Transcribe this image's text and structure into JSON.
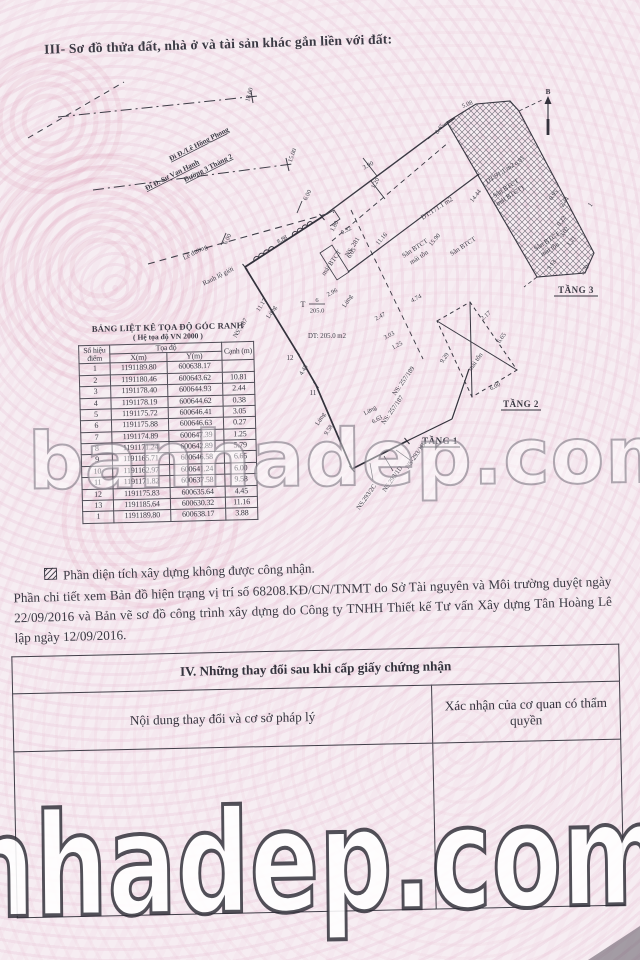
{
  "page_title": "III- Sơ đồ thửa đất, nhà ở và tài sản khác gắn liền với đất:",
  "diagram": {
    "north_label": "B",
    "streets": {
      "le_hong_phong": "Đi Đ./Lê Hồng Phong",
      "su_van_hanh": "Đi Đ. Sư Vạn Hạnh",
      "duong_3_thang_2": "Đường 3 Tháng 2"
    },
    "road_labels": {
      "le_duong": "Lề đường",
      "ranh_lo_gioi": "Ranh lộ giới"
    },
    "parcel": {
      "thua_prefix": "T",
      "thua_number": "6",
      "thua_area": "205.0",
      "area_label": "DT: 205.0 m2"
    },
    "areas": {
      "dt_171": "DT:171.1 m2",
      "dt_91": "DT:91.1 m2",
      "san_btct_a": "Sân BTCT",
      "mai_ton_a": "mái tôn",
      "san_btct_b": "Sân BTCT",
      "san_btct_c": "Sân BTCT",
      "mai_btct_c": "(mái BTCT)",
      "san_btct_d": "Sân BTCT",
      "mai_ton_d": "mái tôn",
      "mai_ton_t2": "mái tôn",
      "mai_btct_strip": "mái BTCT"
    },
    "floors": {
      "tang1": "TẦNG 1",
      "tang2": "TẦNG 2",
      "tang3": "TẦNG 3"
    },
    "house_numbers": [
      "NS. 287",
      "NS. 281",
      "NS: 257/189",
      "NS: 257/187",
      "NS-293/1B",
      "NS.293/1D",
      "NS.293/2C"
    ],
    "mezzanine": "Lửng",
    "points": {
      "p11": "11",
      "p12": "12",
      "p1r": "1"
    },
    "dims": [
      "18.00",
      "15.00",
      "6.00",
      "6.00",
      "8.88",
      "11.17",
      "4.45",
      "9.58",
      "11.16",
      "15.90",
      "14.44",
      "9.01",
      "5.08",
      "3.90",
      "1.20",
      "1.80",
      "0.52",
      "6.05",
      "2.96",
      "2.47",
      "3.03",
      "1.25",
      "0.95",
      "2.44",
      "3.02",
      "1.21",
      "3.13",
      "5.79",
      "4.74",
      "9.29",
      "6.65",
      "6.00",
      "2.17",
      "6.63",
      "0.45",
      "0.22"
    ]
  },
  "coord_table": {
    "title": "BẢNG LIỆT KÊ TỌA ĐỘ GÓC RANH",
    "subtitle": "( Hệ tọa độ VN 2000 )",
    "col_point": "Số hiệu điểm",
    "col_coords": "Tọa độ",
    "col_x": "X(m)",
    "col_y": "Y(m)",
    "col_edge": "Cạnh (m)",
    "rows": [
      [
        "1",
        "1191189.80",
        "600638.17",
        ""
      ],
      [
        "2",
        "1191180.46",
        "600643.62",
        "10.81"
      ],
      [
        "3",
        "1191178.40",
        "600644.93",
        "2.44"
      ],
      [
        "4",
        "1191178.19",
        "600644.62",
        "0.38"
      ],
      [
        "5",
        "1191175.72",
        "600646.41",
        "3.05"
      ],
      [
        "6",
        "1191175.88",
        "600646.63",
        "0.27"
      ],
      [
        "7",
        "1191174.89",
        "600647.39",
        "1.25"
      ],
      [
        "8",
        "1191171.24",
        "600642.89",
        "5.79"
      ],
      [
        "9",
        "1191165.71",
        "600646.58",
        "6.65"
      ],
      [
        "10",
        "1191162.97",
        "600641.24",
        "6.00"
      ],
      [
        "11",
        "1191171.82",
        "600637.58",
        "9.58"
      ],
      [
        "12",
        "1191175.83",
        "600635.64",
        "4.45"
      ],
      [
        "13",
        "1191185.64",
        "600630.32",
        "11.16"
      ],
      [
        "1",
        "1191189.80",
        "600638.17",
        "3.88"
      ]
    ]
  },
  "notes": {
    "legend": "Phần diện tích xây dựng không được công nhận.",
    "paragraph": "Phần chi tiết xem Bản đồ hiện trạng vị trí số 68208.KĐ/CN/TNMT do Sở Tài nguyên và Môi trường duyệt ngày 22/09/2016 và Bản vẽ sơ đồ công trình xây dựng do Công ty TNHH Thiết kế Tư vấn Xây dựng Tân Hoàng Lê lập ngày 12/09/2016."
  },
  "section4": {
    "title": "IV. Những thay đổi sau khi cấp giấy chứng nhận",
    "col_left": "Nội dung thay đổi và cơ sở pháp lý",
    "col_right": "Xác nhận của cơ quan có thẩm quyền"
  },
  "watermarks": {
    "middle": "banhadep.com",
    "bottom": "nhadep.com"
  }
}
